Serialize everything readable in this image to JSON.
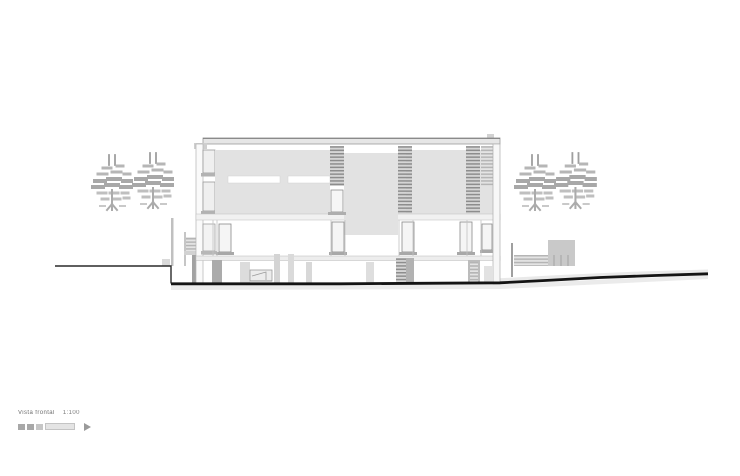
{
  "title_block": {
    "drawing_title": "Vista frontal",
    "scale_text": "1:100"
  },
  "colors": {
    "background": "#ffffff",
    "ground_line": "#141414",
    "panel_gray": "#e2e2e2",
    "louver_dark": "#8d8d8d",
    "louver_light": "#d6d6d6",
    "pier_gray": "#ababab",
    "tree_gray": "#a8a8a8"
  }
}
